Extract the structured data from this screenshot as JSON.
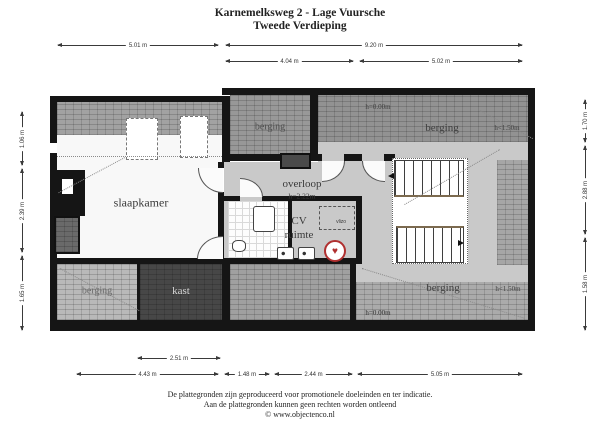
{
  "title": {
    "line1": "Karnemelksweg 2 - Lage Vuursche",
    "line2": "Tweede Verdieping"
  },
  "dimensions": {
    "top_row1": [
      "5.01 m",
      "9.20 m"
    ],
    "top_row2": [
      "4.04 m",
      "5.02 m"
    ],
    "bottom_row1": [
      "2.51 m"
    ],
    "bottom_row2": [
      "4.43 m",
      "1.48 m",
      "2.44 m",
      "5.05 m"
    ],
    "left": [
      "1.06 m",
      "2.39 m",
      "1.65 m"
    ],
    "right": [
      "1.70 m",
      "2.88 m",
      "1.58 m"
    ]
  },
  "rooms": {
    "slaapkamer": "slaapkamer",
    "overloop": "overloop",
    "overloop_height": "h=2.22m",
    "cv_line1": "CV",
    "cv_line2": "ruimte",
    "vlizo": "vlizo",
    "kast": "kast",
    "berging_top_mid": "berging",
    "berging_top_right": "berging",
    "berging_bottom_left": "berging",
    "berging_bottom_right": "berging",
    "h_top_right_zero": "h=0.00m",
    "h_top_right_low": "h<1.50m",
    "h_bottom_right_zero": "h=0.00m",
    "h_bottom_right_low": "h<1.50m"
  },
  "symbols": {
    "cv_boiler": "♥"
  },
  "footer": {
    "line1": "De plattegronden zijn geproduceerd voor promotionele doeleinden en ter indicatie.",
    "line2": "Aan de plattegronden kunnen geen rechten worden ontleend",
    "line3": "© www.objectenco.nl"
  },
  "colors": {
    "wall": "#151515",
    "floor_gray": "#c9c9c9",
    "accent_red": "#b03030",
    "stair_edge": "#7c6a4f"
  }
}
